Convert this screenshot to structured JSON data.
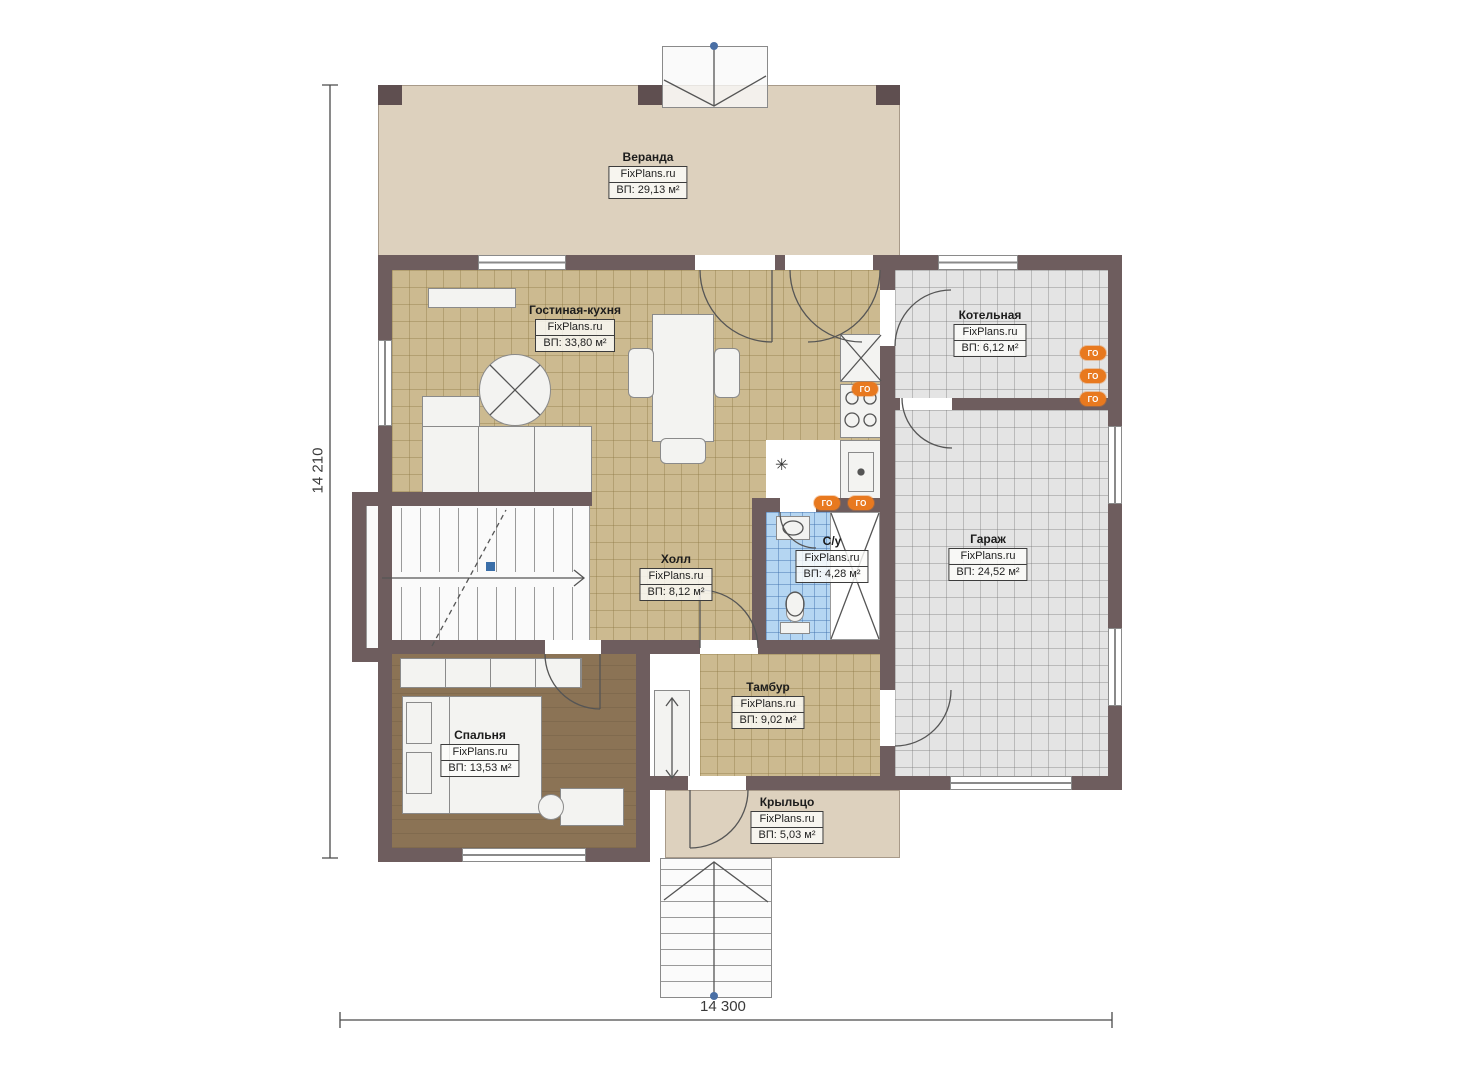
{
  "brand": "FixPlans.ru",
  "rooms": {
    "veranda": {
      "name": "Веранда",
      "area": "ВП: 29,13 м²"
    },
    "living": {
      "name": "Гостиная-кухня",
      "area": "ВП: 33,80 м²"
    },
    "boiler": {
      "name": "Котельная",
      "area": "ВП: 6,12 м²"
    },
    "hall": {
      "name": "Холл",
      "area": "ВП: 8,12 м²"
    },
    "bathroom": {
      "name": "С/у",
      "area": "ВП: 4,28 м²"
    },
    "garage": {
      "name": "Гараж",
      "area": "ВП: 24,52 м²"
    },
    "tambur": {
      "name": "Тамбур",
      "area": "ВП: 9,02 м²"
    },
    "bedroom": {
      "name": "Спальня",
      "area": "ВП: 13,53 м²"
    },
    "porch": {
      "name": "Крыльцо",
      "area": "ВП: 5,03 м²"
    }
  },
  "dimensions": {
    "height": "14 210",
    "width": "14 300"
  },
  "icons": {
    "utility_label": "ГО"
  },
  "colors": {
    "wall": "#6e5d5e",
    "veranda_floor": "#ddd1be",
    "tile_tan": "#ccba90",
    "tile_gray": "#e4e4e4",
    "tile_blue": "#b5d6f2",
    "wood_floor": "#8b7355",
    "accent_orange": "#e8791f",
    "marker_blue": "#4a6fa5"
  }
}
